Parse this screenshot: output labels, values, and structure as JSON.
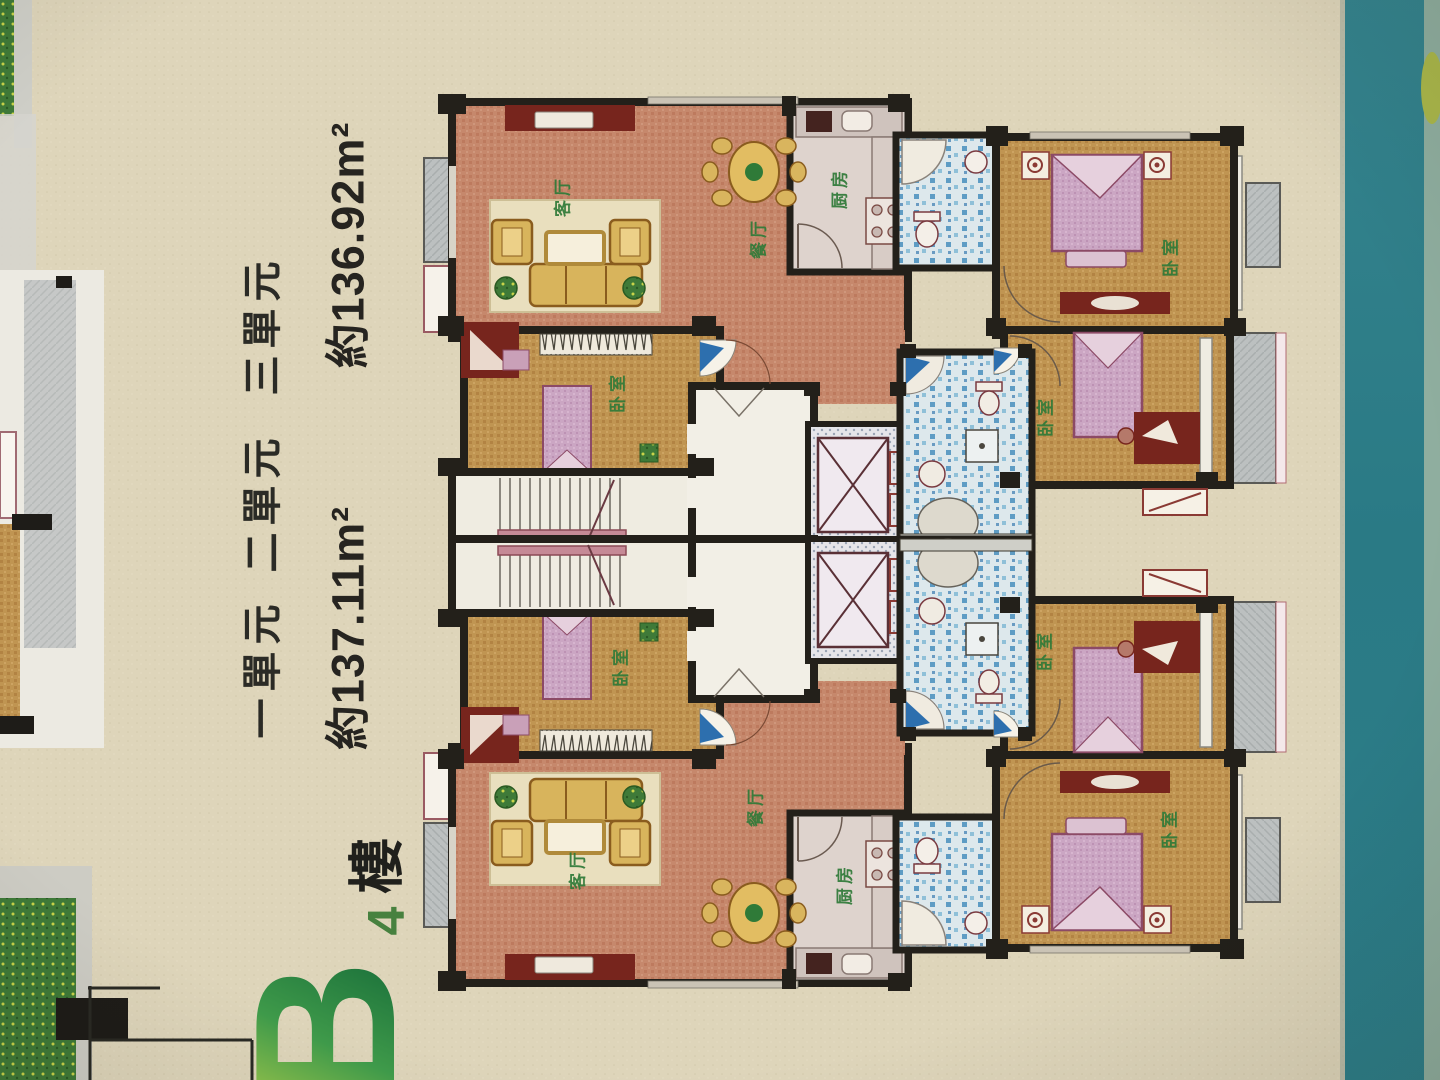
{
  "photo": {
    "unit_labels": [
      {
        "label": "一單元"
      },
      {
        "label": "二單元"
      },
      {
        "label": "三單元"
      }
    ],
    "areas": [
      {
        "label": "約137.11m²"
      },
      {
        "label": "約136.92m²"
      }
    ],
    "block": {
      "letter": "B",
      "floor_number": "4",
      "floor_word": "樓"
    },
    "room_labels": {
      "living": "客厅",
      "dining": "餐厅",
      "kitchen": "厨房",
      "bedroom": "卧室"
    },
    "colors": {
      "paper": "#ded5ba",
      "teal_stripe": "#2d7e89",
      "wall": "#23201a",
      "salmon_floor": "#c6886c",
      "wood_floor": "#c09552",
      "bed_pink": "#cba6c3",
      "tile_blue": "#5e9cc4",
      "label_green": "#2f7a38",
      "furniture_red": "#77251d",
      "sofa_yellow": "#d8b45c",
      "balcony_grey": "#bcc0c0"
    }
  }
}
